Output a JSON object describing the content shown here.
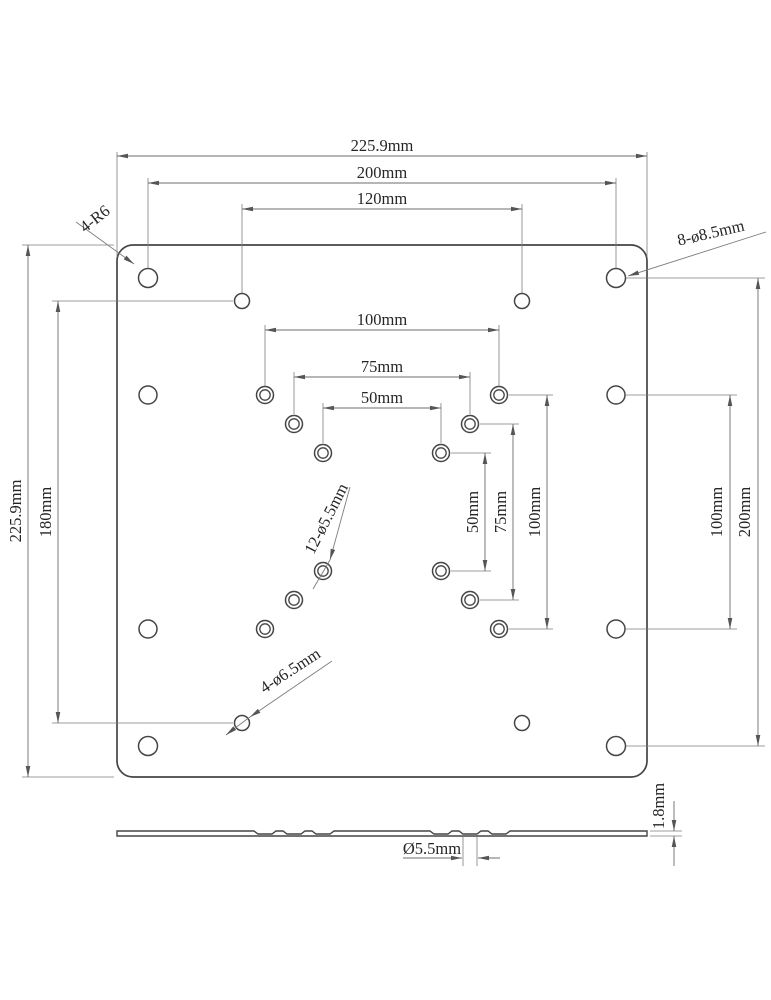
{
  "front_view": {
    "dims_top": {
      "overall_width": "225.9mm",
      "hole_span_200": "200mm",
      "hole_span_120": "120mm"
    },
    "dims_left": {
      "overall_height": "225.9mm",
      "hole_span_180": "180mm"
    },
    "dims_right": {
      "hole_span_100": "100mm",
      "hole_span_200": "200mm"
    },
    "dims_vesa_horizontal": {
      "v100": "100mm",
      "v75": "75mm",
      "v50": "50mm"
    },
    "dims_vesa_vertical": {
      "v50": "50mm",
      "v75": "75mm",
      "v100": "100mm"
    },
    "notes": {
      "corner_radius": "4-R6",
      "outer_holes": "8-ø8.5mm",
      "vesa_holes": "12-ø5.5mm",
      "adapter_holes": "4-ø6.5mm"
    }
  },
  "side_view": {
    "hole_diameter": "Ø5.5mm",
    "thickness": "1.8mm"
  }
}
